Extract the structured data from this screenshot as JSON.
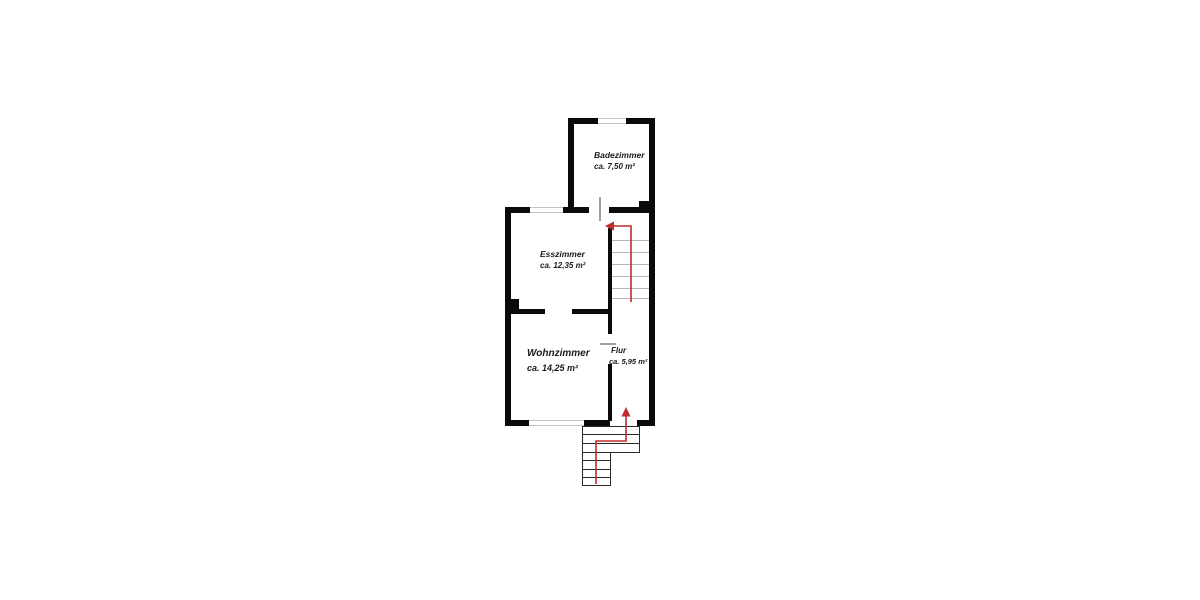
{
  "plan": {
    "type": "floor-plan",
    "rooms": [
      {
        "id": "badezimmer",
        "name": "Badezimmer",
        "area": "ca. 7,50 m²"
      },
      {
        "id": "esszimmer",
        "name": "Esszimmer",
        "area": "ca. 12,35 m²"
      },
      {
        "id": "wohnzimmer",
        "name": "Wohnzimmer",
        "area": "ca. 14,25 m²"
      },
      {
        "id": "flur",
        "name": "Flur",
        "area": "ca. 5,95 m²"
      }
    ],
    "icons": {
      "interior_stair_arrow": "arrow-left",
      "entrance_arrow": "arrow-up"
    },
    "features": {
      "windows": [
        "bathroom-top",
        "dining-top",
        "living-bottom"
      ],
      "doors": [
        "bathroom-door",
        "hall-door",
        "dining-door-opening",
        "entrance-opening"
      ],
      "staircases": [
        "interior-staircase",
        "exterior-entrance-stairs"
      ]
    }
  },
  "colors": {
    "bg": "#ffffff",
    "wall": "#0a0a0a",
    "arrow": "#c22b2b",
    "tread": "#b5b5b5",
    "stair-stroke": "#2b2b2b",
    "door": "#9e9e9e",
    "window-line": "#c4c4c4",
    "text": "#1a1a1a"
  }
}
